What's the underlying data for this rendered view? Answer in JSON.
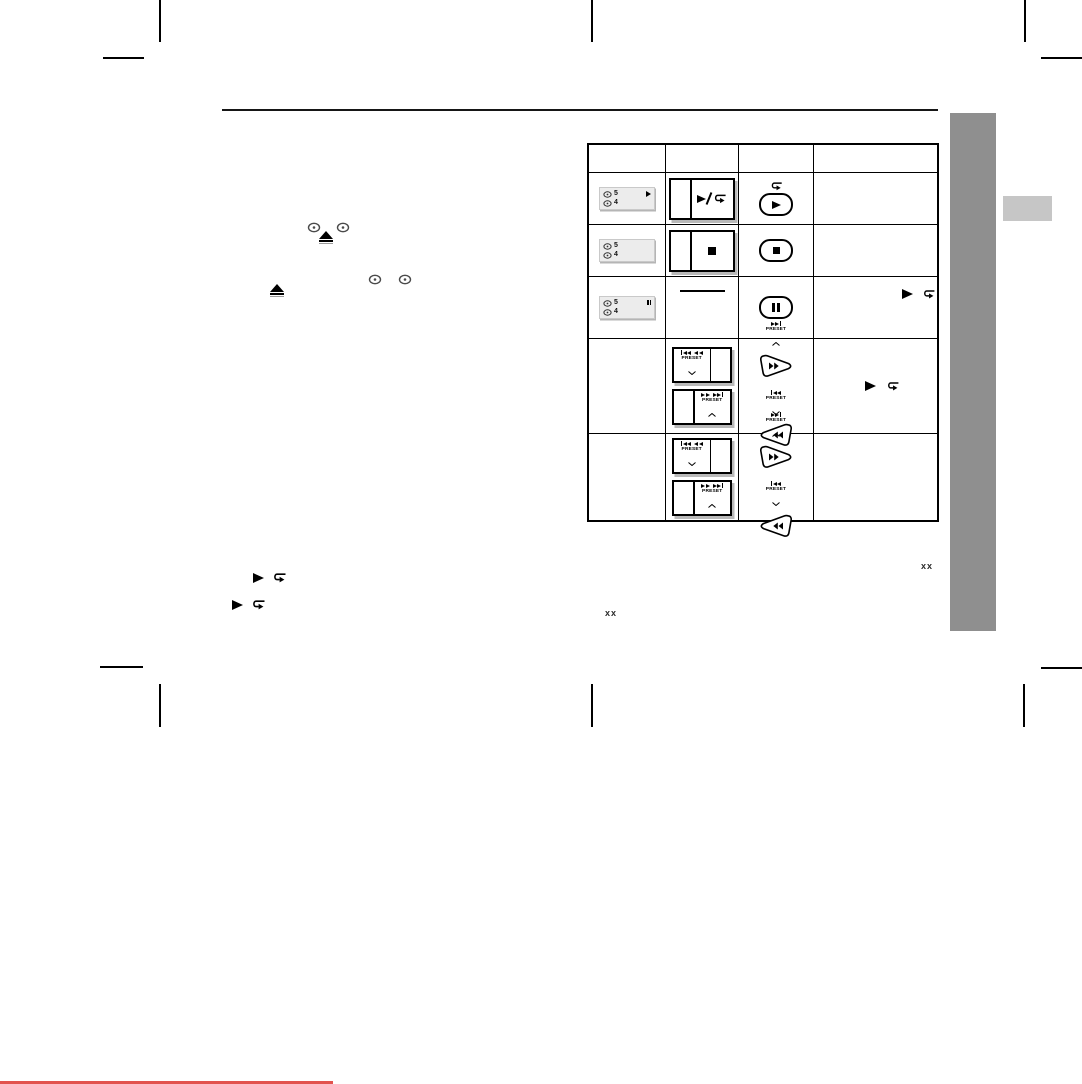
{
  "page": {
    "type": "scanned-manual-page",
    "background": "#ffffff",
    "sidebar_color": "#8f8f8f",
    "sidebar_tab_color": "#c6c6c6",
    "footer_accent_color": "#e2534e",
    "page_ref_right": "xx",
    "page_ref_bottom": "xx"
  },
  "labels": {
    "preset": "PRESET"
  },
  "display": {
    "disc_top_number": "5",
    "disc_bottom_number": "4"
  },
  "icons": {
    "play": "black right-pointing triangle",
    "repeat": "u-turn repeat arrow",
    "stop": "black square",
    "pause": "double vertical bars",
    "eject": "filled triangle over bar",
    "disc": "small disc/ellipse with centre hole",
    "skip_back": "bar + two left triangles",
    "skip_forward": "two right triangles + bar",
    "rewind": "two left triangles",
    "fast_forward": "two right triangles",
    "preset_up": "chevron up",
    "preset_down": "chevron down"
  },
  "table": {
    "header": [
      "",
      "",
      "",
      ""
    ],
    "rows": [
      {
        "display": "disc 5 playing / disc 4",
        "unit_button": "play + repeat split key",
        "remote_button": "repeat mark over play oval key",
        "note": ""
      },
      {
        "display": "disc 5 / disc 4",
        "unit_button": "stop split key",
        "remote_button": "stop oval key",
        "note": ""
      },
      {
        "display": "disc 5 paused / disc 4",
        "unit_button": "none (dash)",
        "remote_button": "pause oval key",
        "note": "play / repeat marks"
      },
      {
        "display": "",
        "unit_button": "skip-back PRESET-down key and fast-forward PRESET-up key",
        "remote_button": "PRESET up pick key (ff) and PRESET down pick key (rew)",
        "note": "play / repeat marks"
      },
      {
        "display": "",
        "unit_button": "skip-back PRESET-down key and fast-forward PRESET-up key",
        "remote_button": "PRESET up pick key (ff) and PRESET down pick key (rew)",
        "note": ""
      }
    ]
  }
}
